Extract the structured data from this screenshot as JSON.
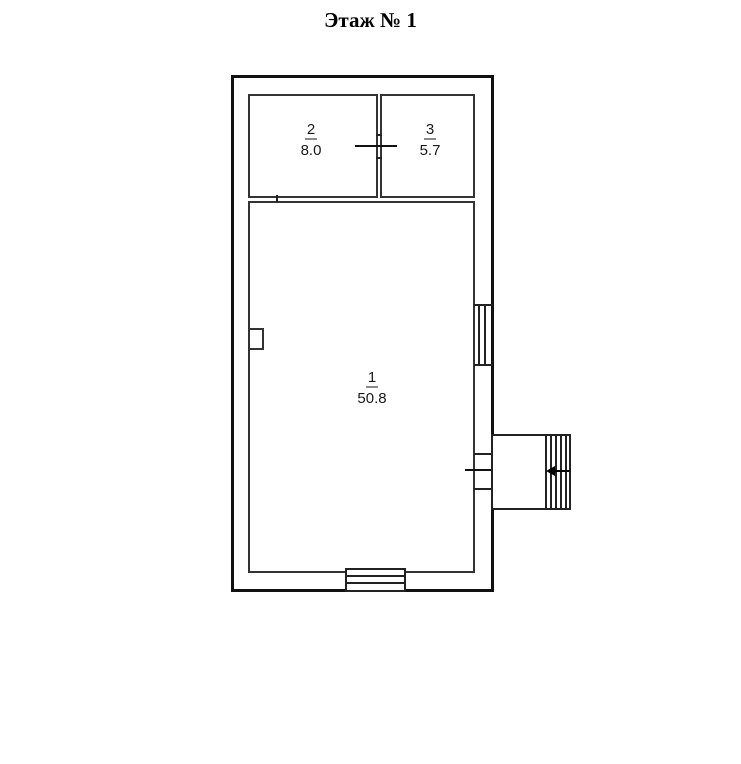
{
  "title": "Этаж № 1",
  "plan": {
    "background_color": "#ffffff",
    "wall_color": "#1a1a1a",
    "rooms": [
      {
        "number": "1",
        "area": "50.8"
      },
      {
        "number": "2",
        "area": "8.0"
      },
      {
        "number": "3",
        "area": "5.7"
      }
    ],
    "symbols": {
      "entrance_arrow_icon": "left-arrow",
      "window_count": 2,
      "door_count": 2,
      "porch_with_steps": true,
      "stove_niche": true
    }
  }
}
